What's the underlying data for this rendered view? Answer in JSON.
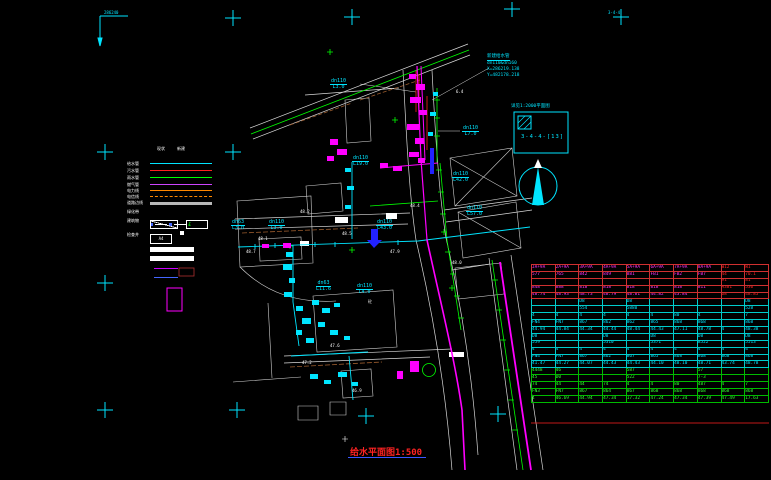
{
  "drawing": {
    "title": "给水平面图1:500",
    "sheet_ref": "3-4-4-[13]",
    "detail_note": "详见1:2000平面图",
    "corner_text": "286240",
    "sheet_mini": "3-4-4",
    "coord_callout": {
      "line0": "新建给水管",
      "line1": "dn110&dn160",
      "line2": "X=286219.138",
      "line3": "Y=482178.218"
    }
  },
  "legend": {
    "col_headers": [
      {
        "text": "现状",
        "x": 30
      },
      {
        "text": "新建",
        "x": 50
      }
    ],
    "rows": [
      {
        "label": "给水管",
        "type": "line",
        "color": "#00e5ff",
        "y": 15
      },
      {
        "label": "污水管",
        "type": "line",
        "color": "#ff2020",
        "y": 22
      },
      {
        "label": "雨水管",
        "type": "line",
        "color": "#00ff00",
        "y": 29
      },
      {
        "label": "燃气管",
        "type": "line",
        "color": "#cc44ff",
        "y": 36
      },
      {
        "label": "电力线",
        "type": "line",
        "color": "#ff8800",
        "y": 42
      },
      {
        "label": "电信线",
        "type": "dash",
        "color": "#ff8800",
        "y": 48
      },
      {
        "label": "道路边线",
        "type": "thick",
        "color": "#b8b8b8",
        "y": 54
      },
      {
        "label": "绿化带",
        "type": "mixed",
        "color": "#ffffff",
        "y": 63
      },
      {
        "label": "建筑物",
        "type": "boxes",
        "color": "#ffffff",
        "y": 72
      },
      {
        "label": "检查井",
        "type": "aa",
        "box_text": "A4",
        "color": "#ffffff",
        "y": 86
      },
      {
        "label": "",
        "type": "bar",
        "color": "#cc00ff",
        "y": 99
      },
      {
        "label": "",
        "type": "bar",
        "color": "#4466ff",
        "y": 108
      }
    ]
  },
  "pipe_labels": [
    {
      "d": "dn110",
      "l": "L3.0",
      "x": 330,
      "y": 79
    },
    {
      "d": "dn110",
      "l": "L7.0",
      "x": 462,
      "y": 126
    },
    {
      "d": "dn110",
      "l": "L19.0",
      "x": 352,
      "y": 156
    },
    {
      "d": "dn63",
      "l": "L3.0",
      "x": 231,
      "y": 220
    },
    {
      "d": "dn110",
      "l": "L3.0",
      "x": 268,
      "y": 220
    },
    {
      "d": "dn110",
      "l": "L43.0",
      "x": 376,
      "y": 220
    },
    {
      "d": "dn110",
      "l": "L42.0",
      "x": 452,
      "y": 172
    },
    {
      "d": "dn110",
      "l": "L57.0",
      "x": 466,
      "y": 206
    },
    {
      "d": "dn63",
      "l": "L11.6",
      "x": 316,
      "y": 281
    },
    {
      "d": "dn110",
      "l": "L4.0",
      "x": 356,
      "y": 284
    }
  ],
  "map_texts": [
    {
      "t": "48.2",
      "x": 300,
      "y": 210
    },
    {
      "t": "48.5",
      "x": 342,
      "y": 232
    },
    {
      "t": "47.9",
      "x": 390,
      "y": 250
    },
    {
      "t": "48.1",
      "x": 258,
      "y": 237
    },
    {
      "t": "48.4",
      "x": 410,
      "y": 204
    },
    {
      "t": "47.6",
      "x": 330,
      "y": 344
    },
    {
      "t": "47.2",
      "x": 302,
      "y": 361
    },
    {
      "t": "46.9",
      "x": 352,
      "y": 389
    },
    {
      "t": "48.0",
      "x": 452,
      "y": 261
    },
    {
      "t": "6.4",
      "x": 456,
      "y": 90
    },
    {
      "t": "砼",
      "x": 368,
      "y": 300
    },
    {
      "t": "48.7",
      "x": 246,
      "y": 250
    }
  ],
  "table": {
    "sections": [
      {
        "border": "#d03030",
        "text": "#ff30ff",
        "red_cols": [
          8,
          9
        ],
        "red": "#ff2020",
        "rows": [
          [
            "JA+9A",
            "2A+9A",
            "3A+9A",
            "4A+9A",
            "5A+9A",
            "6A+9A",
            "7A+9A",
            "8A+9A",
            "W12",
            "W1"
          ],
          [
            "577",
            "765",
            "842",
            "849",
            "881",
            "FB1",
            "FB2",
            "FB7",
            "44",
            "70.1"
          ],
          [
            "",
            "",
            "",
            "",
            "",
            "",
            "",
            "",
            "91",
            "81"
          ],
          [
            "848",
            "888",
            "818",
            "818",
            "818",
            "818",
            "818",
            "811",
            "A381",
            "530"
          ],
          [
            "48.74",
            "48.93",
            "48.73",
            "48.79",
            "48.81",
            "44.82",
            "43.84",
            "",
            "68",
            "48.85"
          ]
        ]
      },
      {
        "border": "#00cccc",
        "text": "#00e5ff",
        "rows": [
          [
            "",
            "",
            "D8",
            "",
            "D8",
            "",
            "",
            "",
            "",
            "D8"
          ],
          [
            "",
            "",
            "554",
            "",
            "5880",
            "",
            "",
            "",
            "",
            "528"
          ],
          [
            "4",
            "4",
            "4",
            "4",
            "4",
            "4",
            "80",
            "4",
            "",
            "7"
          ],
          [
            "FN4",
            "FN7",
            "867",
            "862",
            "862",
            "865",
            "868",
            "868",
            "",
            "868"
          ],
          [
            "44.94",
            "44.84",
            "44.34",
            "44.44",
            "48.44",
            "44.43",
            "47.11",
            "48.78",
            "4",
            "48.38"
          ],
          [
            "D8",
            "",
            "",
            "D8",
            "",
            "D8",
            "",
            "D8",
            "",
            "D8"
          ],
          [
            "559",
            "",
            "",
            "5310",
            "",
            "5371",
            "",
            "8522",
            "",
            "5513"
          ],
          [
            "4",
            "4",
            "4",
            "4",
            "4",
            "4",
            "4",
            "4",
            "4",
            "4"
          ],
          [
            "FN4",
            "FN7",
            "867",
            "862",
            "867",
            "865",
            "868",
            "868",
            "868",
            "868"
          ],
          [
            "41.47",
            "44.27",
            "44.07",
            "44.43",
            "44.43",
            "44.10",
            "48.10",
            "48.71",
            "43.74",
            "48.78"
          ]
        ]
      },
      {
        "border": "#00bb00",
        "text": "#33ff33",
        "rows": [
          [
            "4448",
            "46",
            "",
            "",
            "587",
            "",
            "",
            "57",
            "",
            ""
          ],
          [
            "45",
            "D0",
            "",
            "",
            "522",
            "",
            "",
            "7-3",
            "",
            ""
          ],
          [
            "74",
            "44",
            "44",
            "74",
            "4",
            "4",
            "80",
            "487",
            "4",
            "7"
          ],
          [
            "FN3",
            "FN7",
            "867",
            "864",
            "867",
            "868",
            "868",
            "868",
            "868",
            "868"
          ],
          [
            "4",
            "46.69",
            "44.94",
            "47.34",
            "17.32",
            "47.24",
            "47.34",
            "47.39",
            "47.49",
            "17.63"
          ]
        ]
      }
    ]
  }
}
